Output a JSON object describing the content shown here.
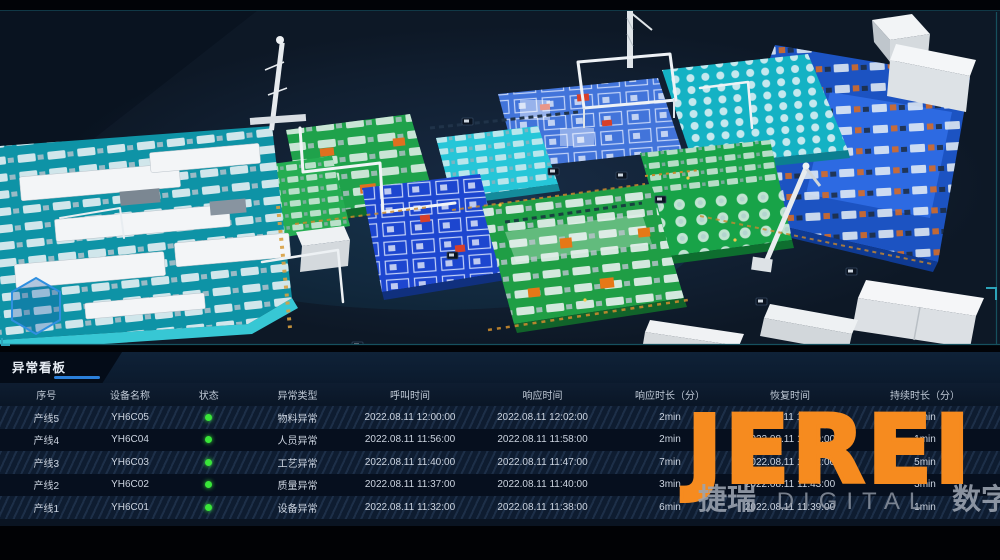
{
  "scene": {
    "description": "3D isometric digital-twin overview of factory production-line platforms",
    "platform_colors": {
      "teal": "#0e93a6",
      "green": "#1fa24b",
      "royal_blue": "#1d46cf",
      "cyan": "#26c6d8",
      "big_blue": "#1c53c2"
    }
  },
  "panel": {
    "title": "异常看板",
    "accent_color": "#2b80da"
  },
  "table": {
    "headers": [
      "序号",
      "设备名称",
      "状态",
      "异常类型",
      "呼叫时间",
      "响应时间",
      "响应时长（分）",
      "恢复时间",
      "持续时长（分）"
    ],
    "status_color": "#39e639",
    "rows": [
      {
        "seq": "产线5",
        "device": "YH6C05",
        "type": "物料异常",
        "call": "2022.08.11 12:00:00",
        "response": "2022.08.11 12:02:00",
        "response_min": "2min",
        "recover": "2022.08.11 12:05:00",
        "duration": "3min"
      },
      {
        "seq": "产线4",
        "device": "YH6C04",
        "type": "人员异常",
        "call": "2022.08.11 11:56:00",
        "response": "2022.08.11 11:58:00",
        "response_min": "2min",
        "recover": "2022.08.11 11:59:00",
        "duration": "1min"
      },
      {
        "seq": "产线3",
        "device": "YH6C03",
        "type": "工艺异常",
        "call": "2022.08.11 11:40:00",
        "response": "2022.08.11 11:47:00",
        "response_min": "7min",
        "recover": "2022.08.11 11:52:00",
        "duration": "5min"
      },
      {
        "seq": "产线2",
        "device": "YH6C02",
        "type": "质量异常",
        "call": "2022.08.11 11:37:00",
        "response": "2022.08.11 11:40:00",
        "response_min": "3min",
        "recover": "2022.08.11 11:43:00",
        "duration": "3min"
      },
      {
        "seq": "产线1",
        "device": "YH6C01",
        "type": "设备异常",
        "call": "2022.08.11 11:32:00",
        "response": "2022.08.11 11:38:00",
        "response_min": "6min",
        "recover": "2022.08.11 11:39:00",
        "duration": "1min"
      }
    ]
  },
  "watermark": {
    "logo": "JEREI",
    "logo_color": "#f68b1f",
    "sub_zh_left": "捷瑞",
    "sub_en": "DIGITAL",
    "sub_zh_right": "数字"
  }
}
